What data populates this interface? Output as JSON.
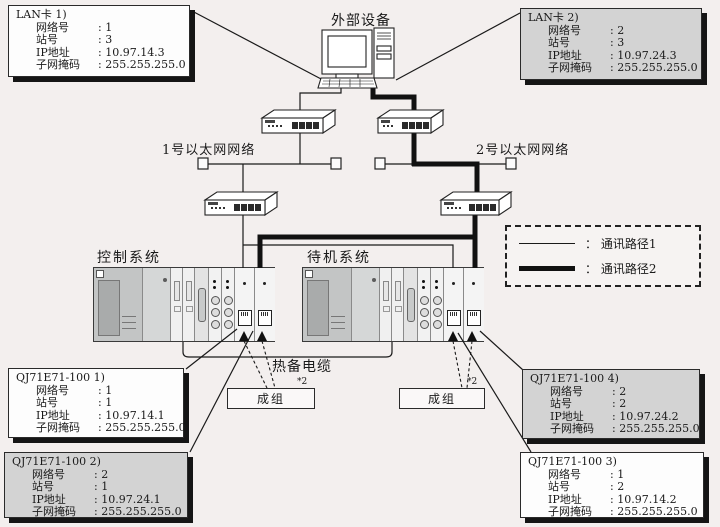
{
  "labels": {
    "external_device": "外部设备",
    "network1": "1号以太网网络",
    "network2": "2号以太网网络",
    "control_system": "控制系统",
    "standby_system": "待机系统",
    "hot_standby_cable": "热备电缆",
    "group_left": "成组",
    "group_right": "成组",
    "footnote_left": "*2",
    "footnote_right": "*2"
  },
  "legend": {
    "items": [
      {
        "label": "：  通讯路径1"
      },
      {
        "label": "：  通讯路径2"
      }
    ]
  },
  "colors": {
    "background": "#f3efee",
    "box_gray": "#d3d3d3",
    "box_white": "#fdfdfd",
    "shadow": "#151515",
    "rack_band": "#8d939a",
    "line": "#1a1a1a"
  },
  "info_boxes": {
    "lan1": {
      "title": "LAN卡 1)",
      "rows": [
        {
          "label": "网络号",
          "value": ": 1"
        },
        {
          "label": "站号",
          "value": ": 3"
        },
        {
          "label": "IP地址",
          "value": ": 10.97.14.3"
        },
        {
          "label": "子网掩码",
          "value": ": 255.255.255.0"
        }
      ]
    },
    "lan2": {
      "title": "LAN卡 2)",
      "rows": [
        {
          "label": "网络号",
          "value": ": 2"
        },
        {
          "label": "站号",
          "value": ": 3"
        },
        {
          "label": "IP地址",
          "value": ": 10.97.24.3"
        },
        {
          "label": "子网掩码",
          "value": ": 255.255.255.0"
        }
      ]
    },
    "e71_1": {
      "title": "QJ71E71-100 1)",
      "rows": [
        {
          "label": "网络号",
          "value": ": 1"
        },
        {
          "label": "站号",
          "value": ": 1"
        },
        {
          "label": "IP地址",
          "value": ": 10.97.14.1"
        },
        {
          "label": "子网掩码",
          "value": ": 255.255.255.0"
        }
      ]
    },
    "e71_2": {
      "title": "QJ71E71-100 2)",
      "rows": [
        {
          "label": "网络号",
          "value": ": 2"
        },
        {
          "label": "站号",
          "value": ": 1"
        },
        {
          "label": "IP地址",
          "value": ": 10.97.24.1"
        },
        {
          "label": "子网掩码",
          "value": ": 255.255.255.0"
        }
      ]
    },
    "e71_3": {
      "title": "QJ71E71-100 3)",
      "rows": [
        {
          "label": "网络号",
          "value": ": 1"
        },
        {
          "label": "站号",
          "value": ": 2"
        },
        {
          "label": "IP地址",
          "value": ": 10.97.14.2"
        },
        {
          "label": "子网掩码",
          "value": ": 255.255.255.0"
        }
      ]
    },
    "e71_4": {
      "title": "QJ71E71-100 4)",
      "rows": [
        {
          "label": "网络号",
          "value": ": 2"
        },
        {
          "label": "站号",
          "value": ": 2"
        },
        {
          "label": "IP地址",
          "value": ": 10.97.24.2"
        },
        {
          "label": "子网掩码",
          "value": ": 255.255.255.0"
        }
      ]
    }
  }
}
